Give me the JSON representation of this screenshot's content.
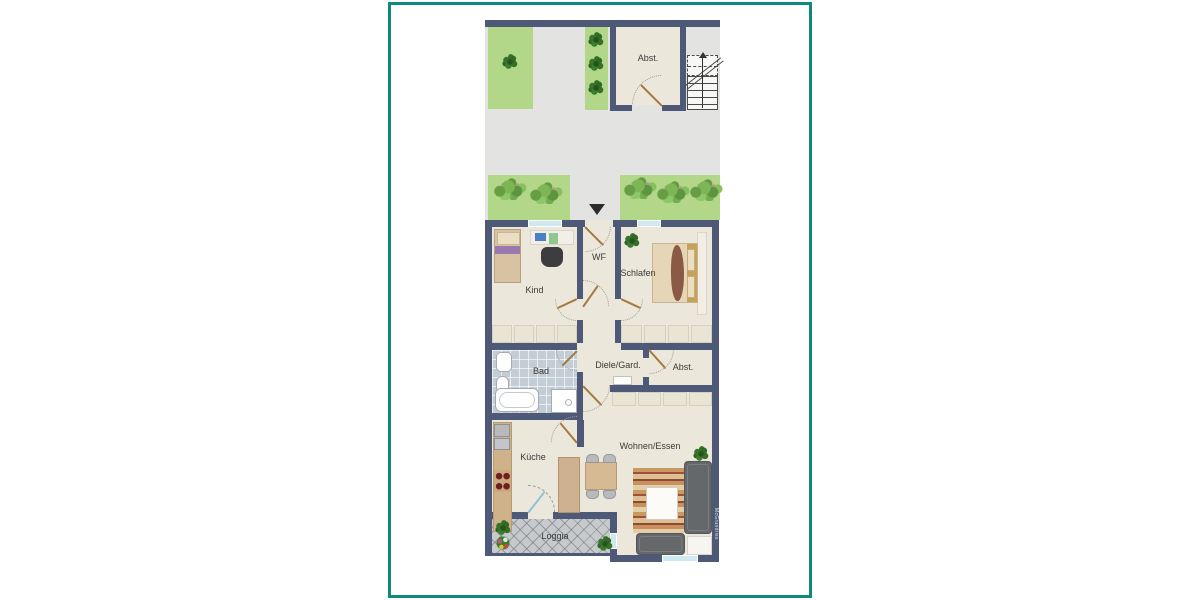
{
  "frame": {
    "accent_color": "#0d8a7b",
    "background": "#ffffff"
  },
  "floorplan": {
    "watermark": "McGrundriss",
    "colors": {
      "wall": "#4e5877",
      "floor": "#ece7db",
      "lawn": "#b2d788",
      "outdoor_path": "#e3e3e2",
      "bath_tile": "#c3cdd6",
      "loggia_tile": "#c7cacc",
      "door_leaf": "#a57a3e",
      "window_glass": "#cfe9f0"
    },
    "labels": {
      "abst_top": "Abst.",
      "wf": "WF",
      "kind": "Kind",
      "schlafen": "Schlafen",
      "bad": "Bad",
      "diele": "Diele/Gard.",
      "abst_mid": "Abst.",
      "kueche": "Küche",
      "wohnen": "Wohnen/Essen",
      "loggia": "Loggia"
    }
  }
}
